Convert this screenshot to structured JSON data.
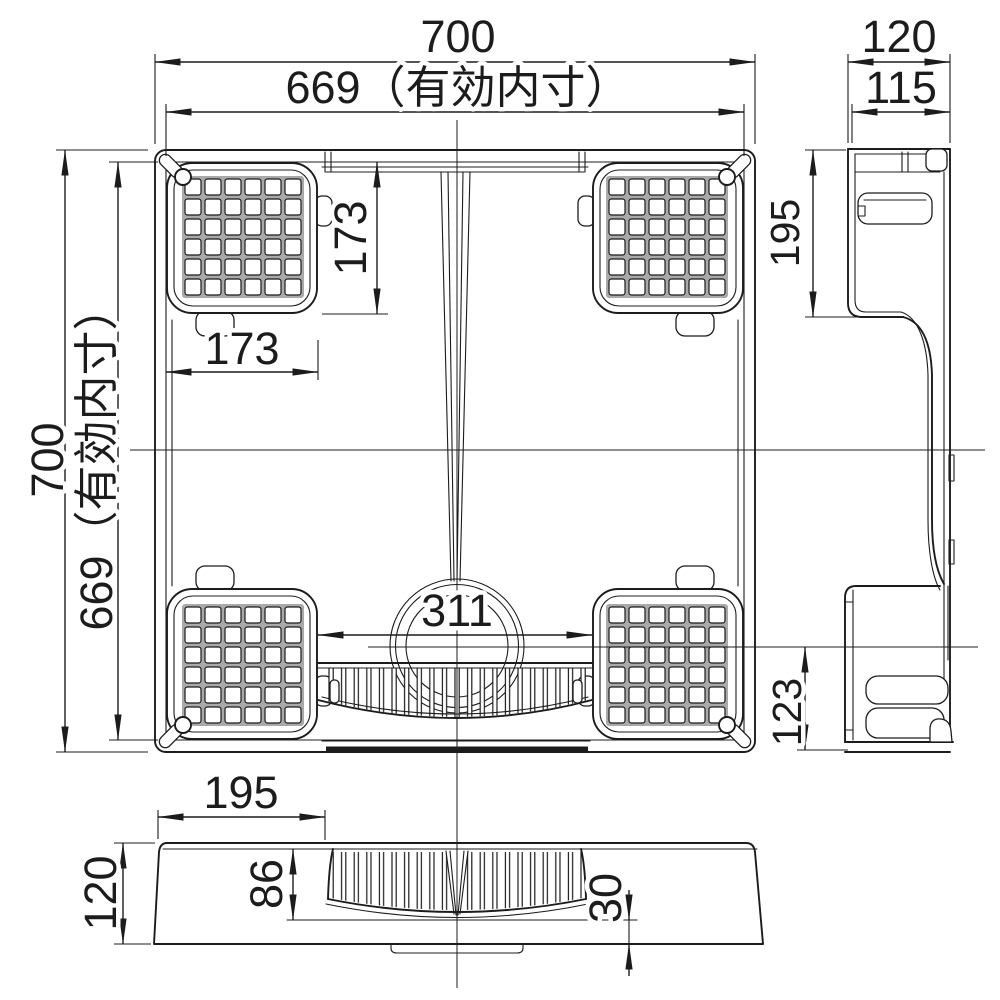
{
  "drawing": {
    "views": {
      "plan": {
        "width": "700",
        "inner_width": "669（有効内寸）",
        "height": "700",
        "inner_height": "669（有効内寸）",
        "pad_width": "173",
        "pad_height": "173",
        "drain_span": "311"
      },
      "side": {
        "width": "120",
        "inner_width": "115",
        "depth": "195",
        "drain_depth": "123"
      },
      "front": {
        "pad_span": "195",
        "height": "120",
        "grille_height": "86",
        "base_height": "30"
      }
    },
    "colors": {
      "line": "#1c1c1c",
      "grid_gap": "#a9a9a9",
      "background": "#ffffff"
    }
  }
}
